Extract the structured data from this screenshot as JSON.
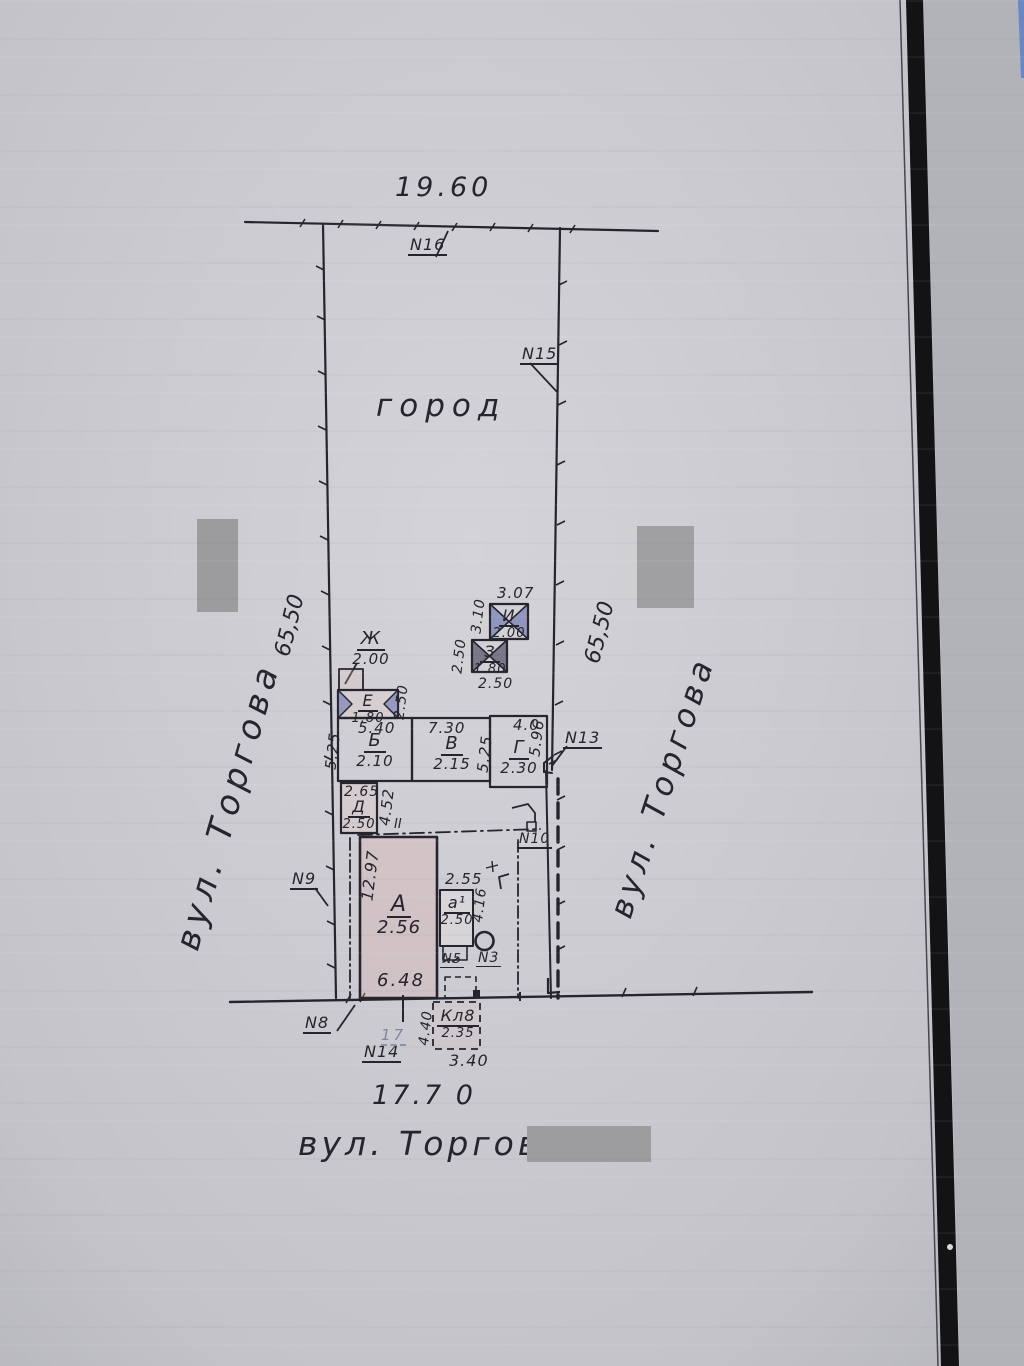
{
  "colors": {
    "paper": "#c9c9cf",
    "ink": "#26242c",
    "building_fill_pink": "#e8d4d2",
    "hatch_blue": "#7b86c4",
    "hatch_dark": "#55556a",
    "redaction_gray": "#9c9c9f",
    "scan_band_black": "#131316",
    "edge_blue_sliver": "#5d7fc0",
    "faint_pencil_blue": "#7e86a0"
  },
  "plan": {
    "garden_label": "город",
    "top_dimension": "19.60",
    "bottom_dimension": "17.7 0",
    "left_boundary_length": "65,50",
    "right_boundary_length": "65,50",
    "left_street_name": "вул. Торгова",
    "right_street_name": "вул. Торгова",
    "bottom_street_name": "вул. Торгова",
    "faint_house_number": "17",
    "fence_section_mark": "II",
    "survey_marks": {
      "n16": "N16",
      "n15": "N15",
      "n13": "N13",
      "n10": "N10",
      "n9": "N9",
      "n8": "N8",
      "n14": "N14",
      "n5": "N5",
      "n3": "N3"
    },
    "buildings": {
      "A": {
        "letter": "А",
        "value": "2.56",
        "dim_left": "12.97",
        "dim_bottom": "6.48"
      },
      "a1": {
        "letter": "а¹",
        "value": "2.50",
        "dim_top": "2.55",
        "dim_right": "4.16"
      },
      "B": {
        "letter": "Б",
        "value": "2.10",
        "dim_top": "5.40",
        "dim_left": "5.25"
      },
      "V": {
        "letter": "В",
        "value": "2.15",
        "dim_top": "7.30",
        "dim_right": "5.25"
      },
      "G": {
        "letter": "Г",
        "value": "2.30",
        "dim_top": "4.0",
        "dim_right": "5.96"
      },
      "D": {
        "letter": "Д",
        "value": "2.50",
        "dim_top": "2.65",
        "dim_right": "4.52"
      },
      "E": {
        "letter": "Е",
        "value": "1.80",
        "dim_right": "2.50"
      },
      "Zh": {
        "letter": "Ж",
        "value": "2.00"
      },
      "Z": {
        "letter": "З",
        "value": "1.80",
        "dim_left": "2.50",
        "dim_bottom": "2.50"
      },
      "I": {
        "letter": "И",
        "value": "2.00",
        "dim_top": "3.07",
        "dim_left": "3.10"
      },
      "Kl": {
        "letter": "Кл8",
        "value": "2.35",
        "dim_left": "4.40",
        "dim_bottom": "3.40"
      }
    }
  }
}
